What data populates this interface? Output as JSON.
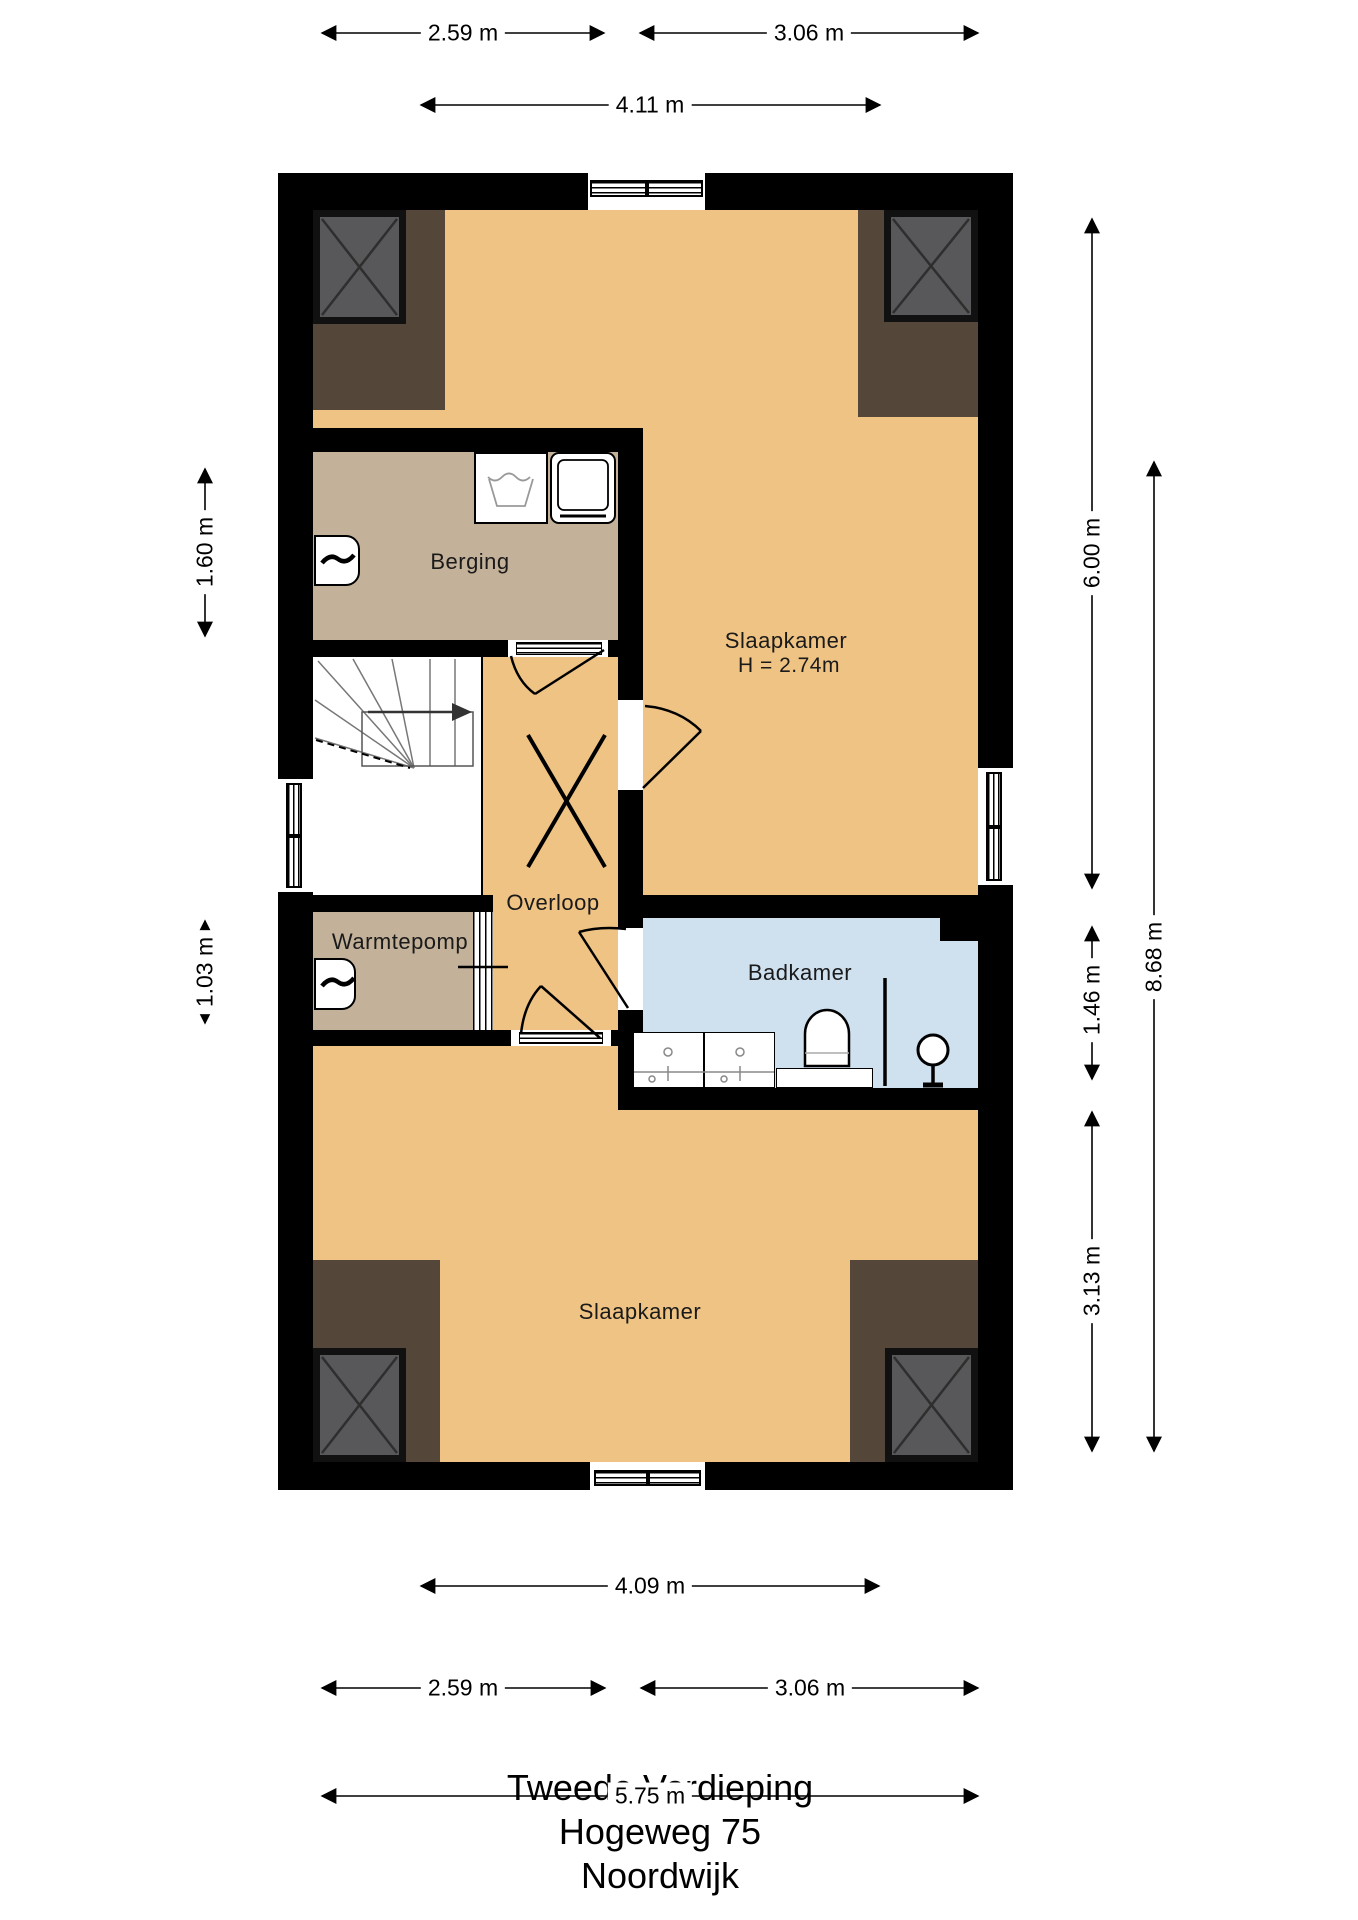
{
  "meta": {
    "drawing_type": "floor-plan"
  },
  "title": {
    "line1": "Tweede Verdieping",
    "line2": "Hogeweg 75",
    "line3": "Noordwijk"
  },
  "rooms": {
    "slaapkamer_top": {
      "label": "Slaapkamer",
      "height_note": "H = 2.74m"
    },
    "berging": {
      "label": "Berging"
    },
    "overloop": {
      "label": "Overloop"
    },
    "warmtepomp": {
      "label": "Warmtepomp"
    },
    "badkamer": {
      "label": "Badkamer"
    },
    "slaapkamer_bottom": {
      "label": "Slaapkamer"
    }
  },
  "dimensions": {
    "top": {
      "left": "2.59 m",
      "right": "3.06 m",
      "inner": "4.11 m"
    },
    "bottom": {
      "inner": "4.09 m",
      "left": "2.59 m",
      "right": "3.06 m",
      "total": "5.75 m"
    },
    "left": {
      "upper": "1.60 m",
      "lower": "1.03 m"
    },
    "right": {
      "top": "6.00 m",
      "middle": "1.46 m",
      "bottom": "3.13 m",
      "total": "8.68 m"
    }
  },
  "colors": {
    "wall": "#000000",
    "floor_main": "#efc383",
    "floor_secondary": "#c3b199",
    "floor_bathroom": "#cfe0ef",
    "roof_slope": "#54473a",
    "shaft_fill": "#58585a"
  },
  "icons": {
    "stairs_up_arrow": "direction-of-stairs",
    "washer": "washbasin-symbol",
    "dryer": "dryer-symbol",
    "radiator": "heater-symbol",
    "toilet": "toilet-symbol",
    "shower": "shower-symbol"
  }
}
